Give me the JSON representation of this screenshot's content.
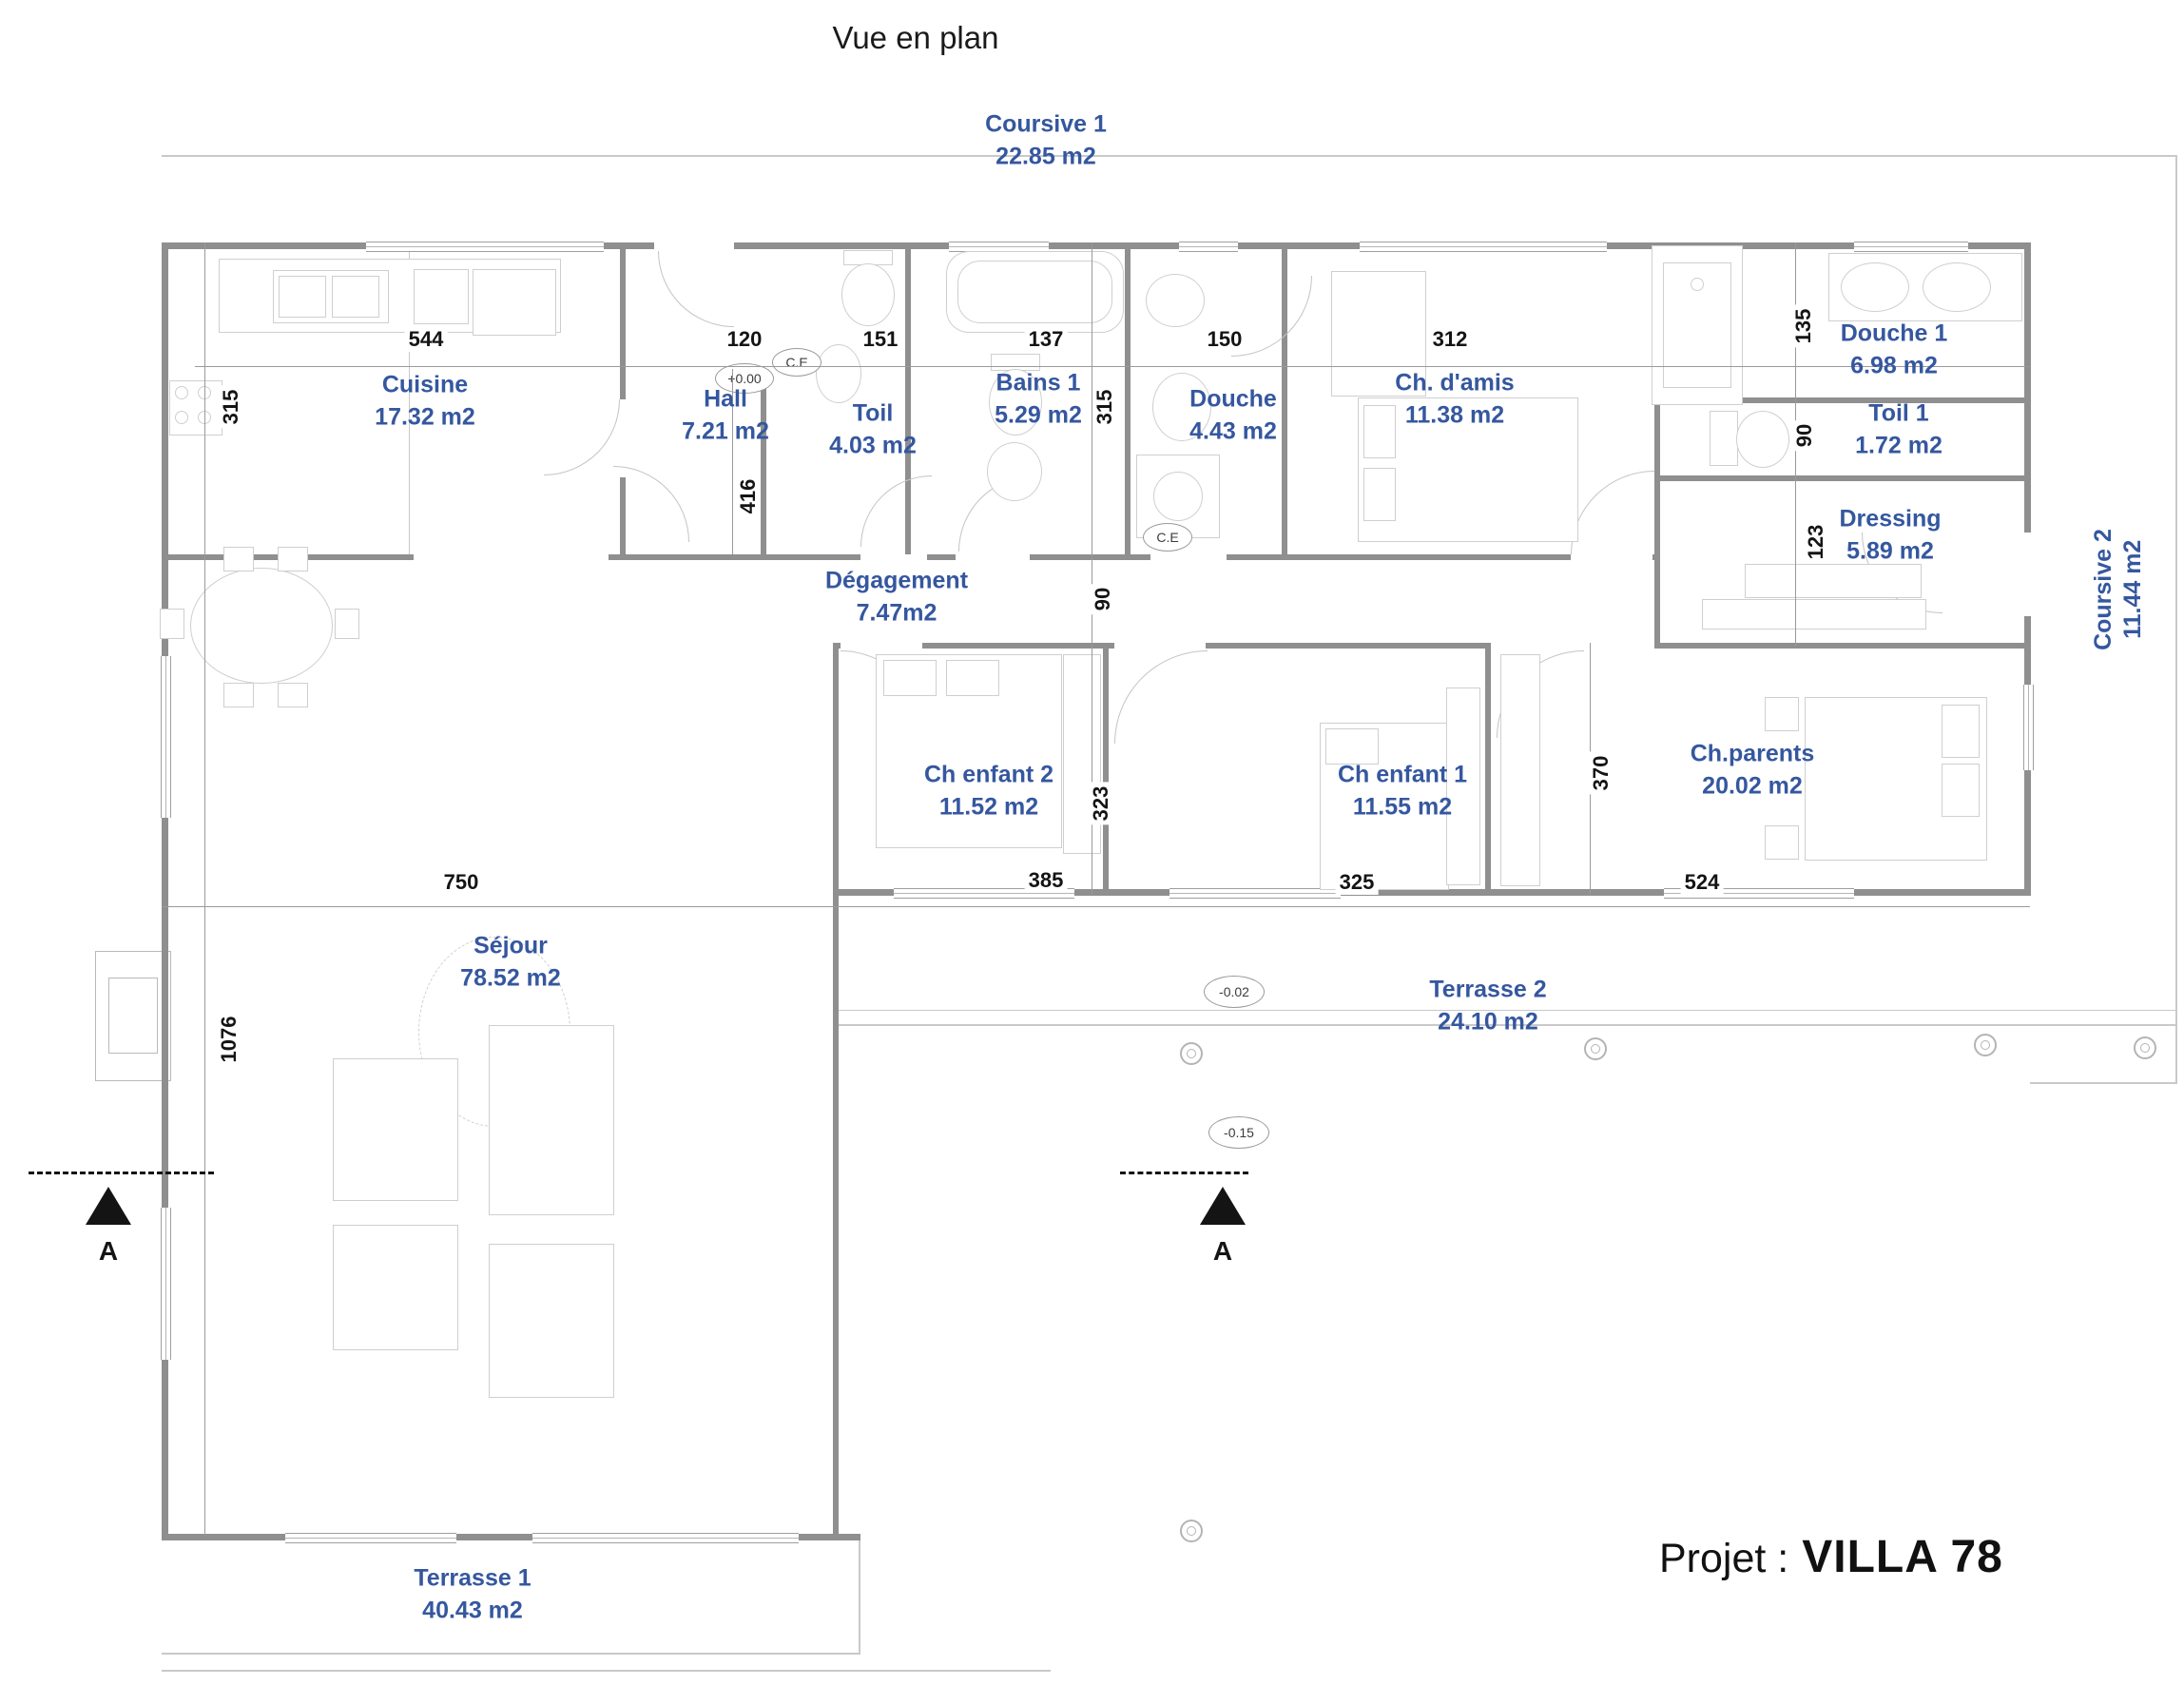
{
  "title": "Vue en plan",
  "project": {
    "label": "Projet :",
    "name": "VILLA 78"
  },
  "accent_color": "#35579f",
  "rooms": [
    {
      "name": "Coursive 1",
      "area": "22.85 m2"
    },
    {
      "name": "Cuisine",
      "area": "17.32 m2"
    },
    {
      "name": "Hall",
      "area": "7.21 m2"
    },
    {
      "name": "Toil",
      "area": "4.03 m2"
    },
    {
      "name": "Bains 1",
      "area": "5.29 m2"
    },
    {
      "name": "Douche",
      "area": "4.43 m2"
    },
    {
      "name": "Ch. d'amis",
      "area": "11.38 m2"
    },
    {
      "name": "Douche 1",
      "area": "6.98 m2"
    },
    {
      "name": "Toil 1",
      "area": "1.72 m2"
    },
    {
      "name": "Dressing",
      "area": "5.89 m2"
    },
    {
      "name": "Coursive 2",
      "area": "11.44 m2"
    },
    {
      "name": "Dégagement",
      "area": "7.47m2"
    },
    {
      "name": "Ch enfant 2",
      "area": "11.52 m2"
    },
    {
      "name": "Ch enfant 1",
      "area": "11.55 m2"
    },
    {
      "name": "Ch.parents",
      "area": "20.02 m2"
    },
    {
      "name": "Séjour",
      "area": "78.52 m2"
    },
    {
      "name": "Terrasse 2",
      "area": "24.10 m2"
    },
    {
      "name": "Terrasse 1",
      "area": "40.43 m2"
    }
  ],
  "dims_h": [
    "544",
    "120",
    "151",
    "137",
    "150",
    "312",
    "750",
    "385",
    "325",
    "524"
  ],
  "dims_v": [
    "315",
    "315",
    "416",
    "90",
    "323",
    "370",
    "135",
    "90",
    "123",
    "1076"
  ],
  "levels": [
    "+0.00",
    "-0.02",
    "-0.15"
  ],
  "equipment": {
    "water_heater": "C.E"
  },
  "section": {
    "label": "A"
  }
}
